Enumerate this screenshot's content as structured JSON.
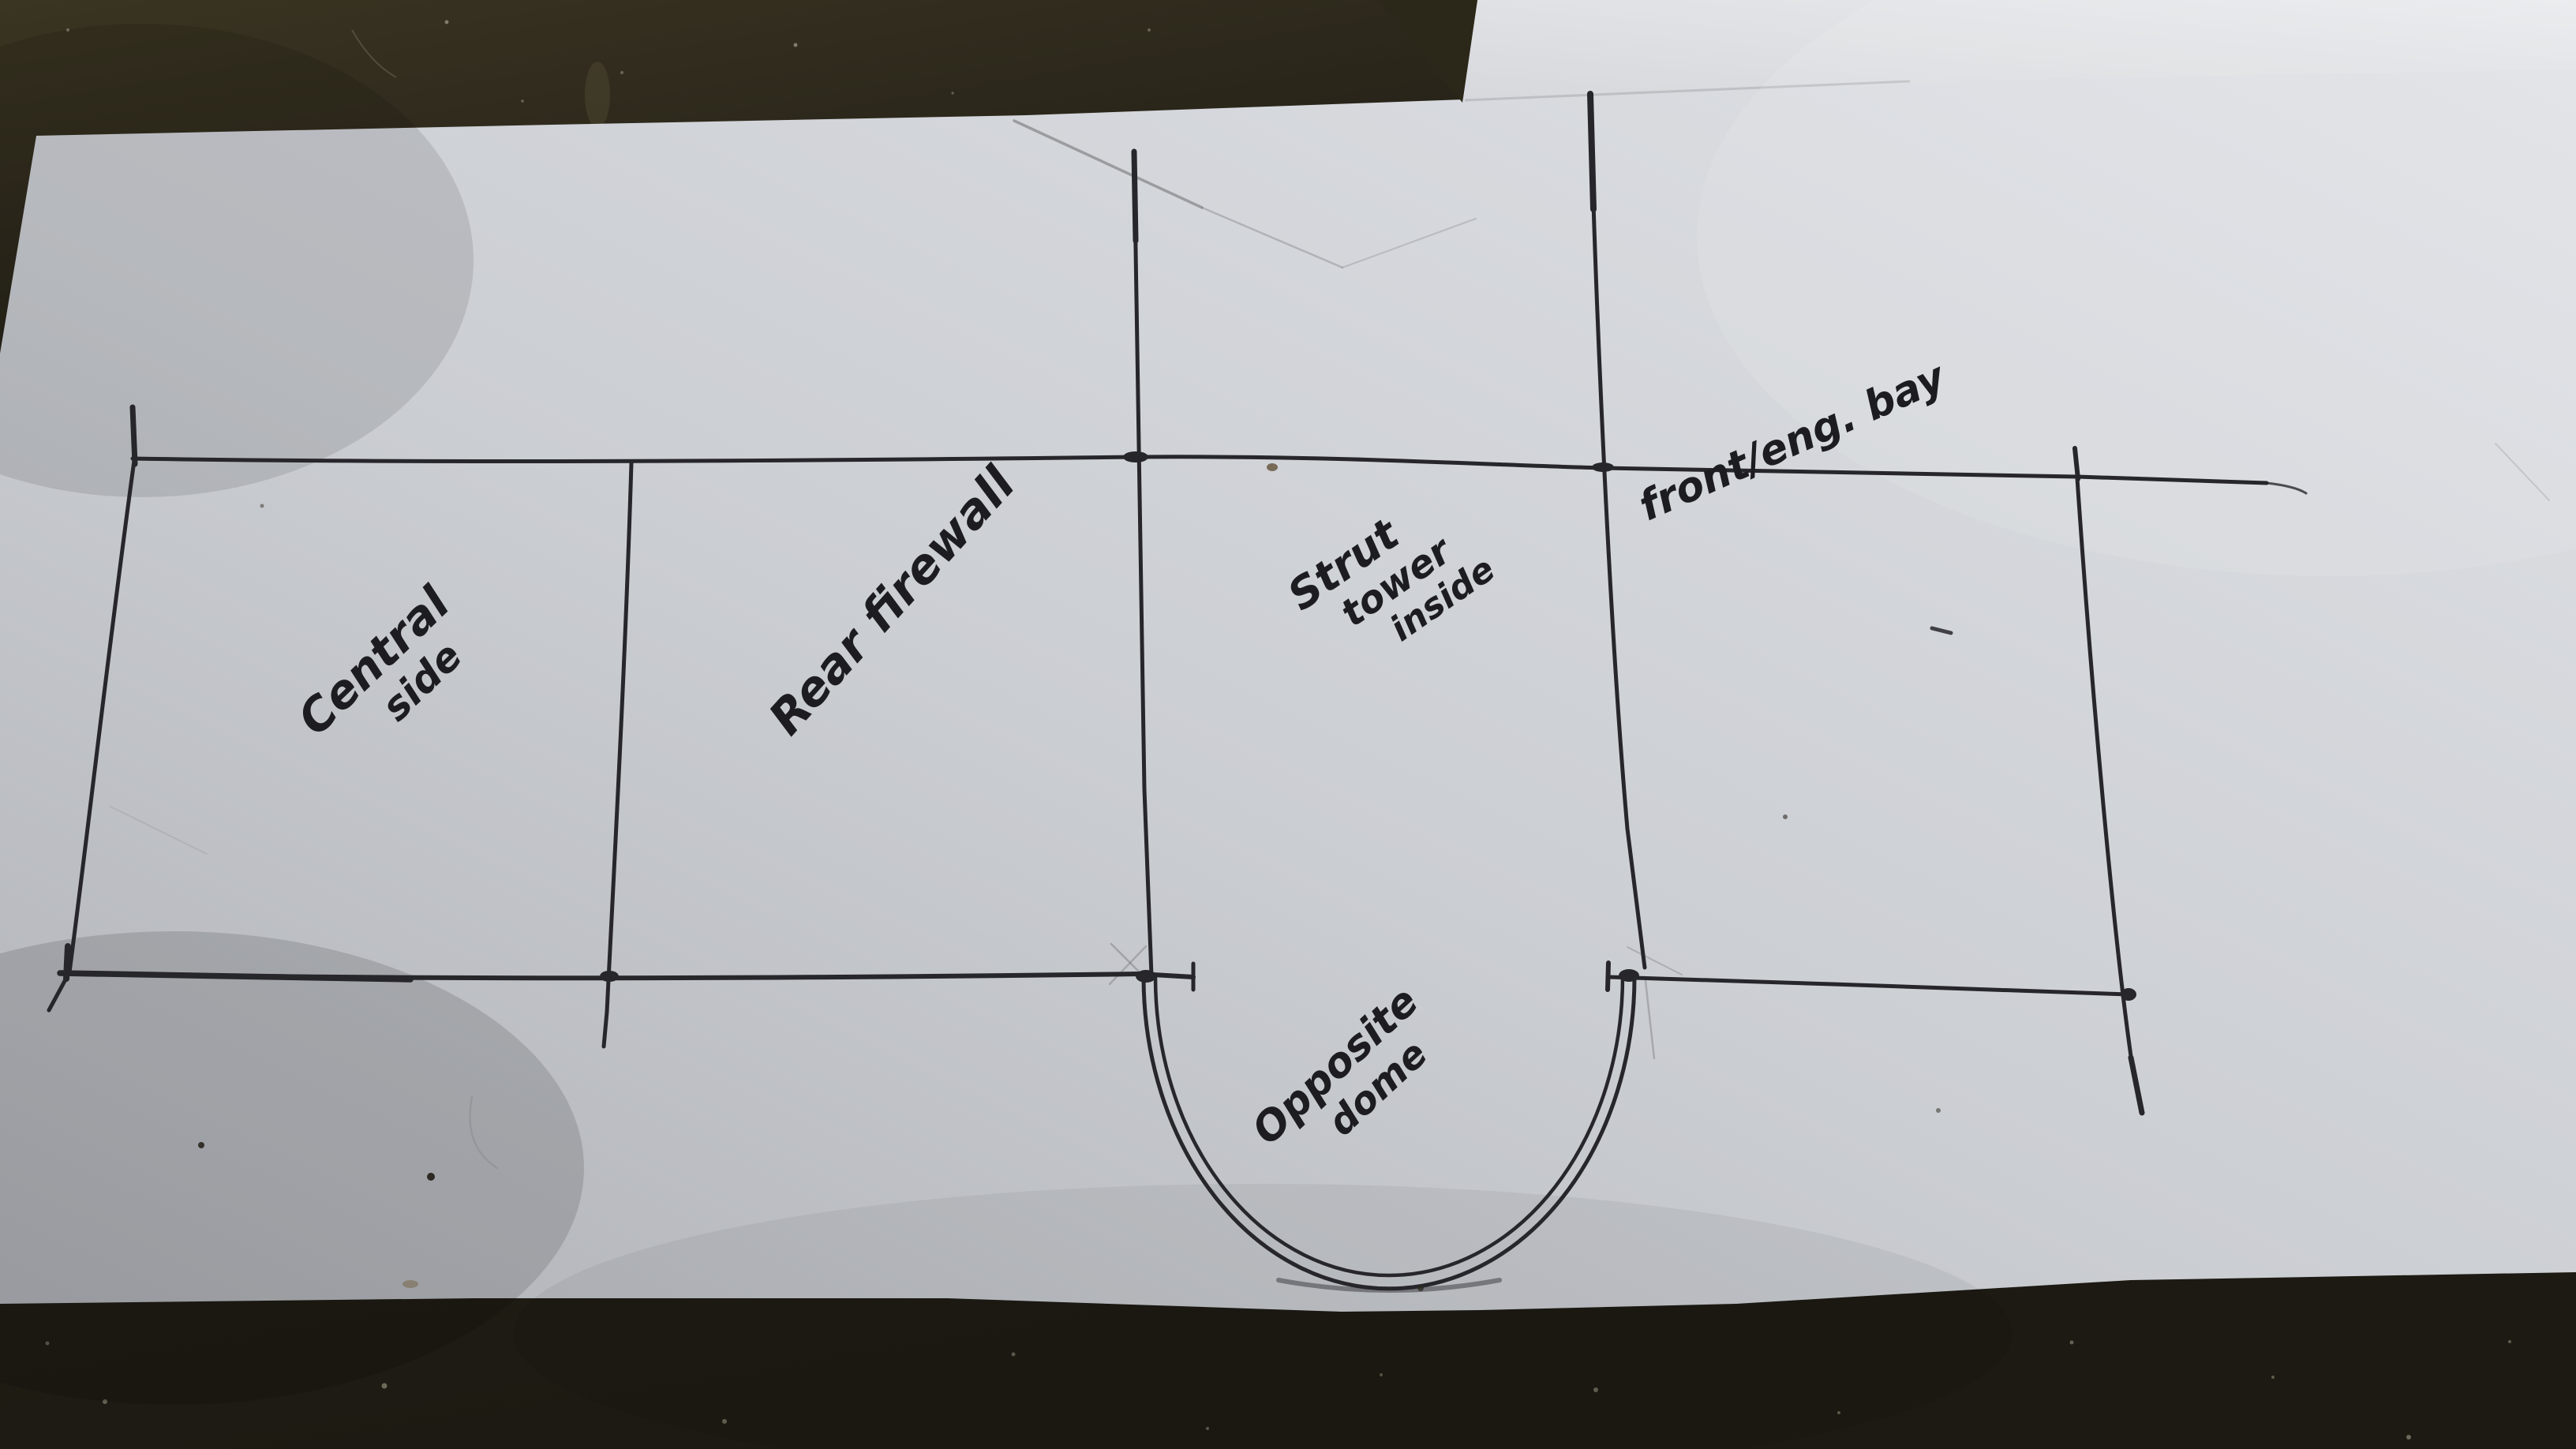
{
  "drawing": {
    "sections": [
      {
        "name": "left-side-panel",
        "label_lines": [
          "Central",
          "side"
        ]
      },
      {
        "name": "rear-firewall-panel",
        "label_lines": [
          "Rear firewall"
        ]
      },
      {
        "name": "strut-tower-panel",
        "label_lines": [
          "Strut",
          "tower",
          "inside"
        ]
      },
      {
        "name": "front-engine-bay-panel",
        "label_lines": [
          "front/eng. bay"
        ]
      },
      {
        "name": "dome-cutout",
        "label_lines": [
          "Opposite",
          "dome"
        ]
      }
    ]
  },
  "colors": {
    "paper": "#cbced3",
    "paper_bright": "#e8eaec",
    "floor": "#221f15",
    "ink": "#26262b",
    "pencil": "#7c7c81"
  }
}
